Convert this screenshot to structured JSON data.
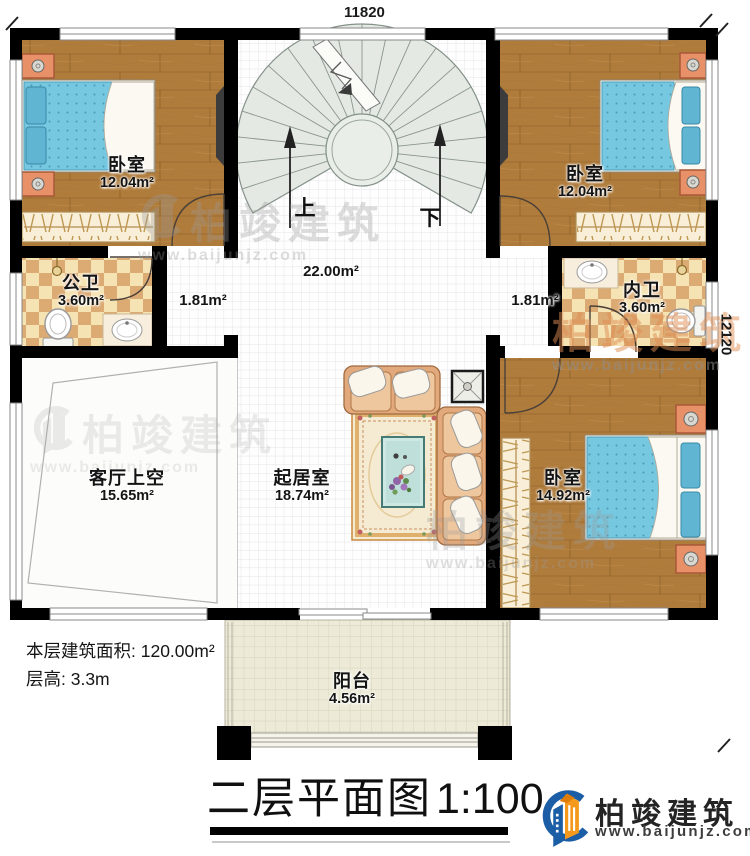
{
  "dimensions": {
    "top": "11820",
    "right": "12120"
  },
  "rooms": {
    "bedroom_tl": {
      "name": "卧室",
      "area": "12.04m²"
    },
    "bedroom_tr": {
      "name": "卧室",
      "area": "12.04m²"
    },
    "bedroom_br": {
      "name": "卧室",
      "area": "14.92m²"
    },
    "public_bath": {
      "name": "公卫",
      "area": "3.60m²"
    },
    "private_bath": {
      "name": "内卫",
      "area": "3.60m²"
    },
    "hall": {
      "area": "22.00m²"
    },
    "corridor_left": {
      "area": "1.81m²"
    },
    "corridor_right": {
      "area": "1.81m²"
    },
    "living_void": {
      "name": "客厅上空",
      "area": "15.65m²"
    },
    "living": {
      "name": "起居室",
      "area": "18.74m²"
    },
    "balcony": {
      "name": "阳台",
      "area": "4.56m²"
    }
  },
  "stairs": {
    "up": "上",
    "down": "下"
  },
  "info": {
    "floor_area": "本层建筑面积: 120.00m²",
    "floor_height": "层高: 3.3m"
  },
  "title": {
    "name": "二层平面图",
    "scale": "1:100"
  },
  "brand": {
    "name": "柏竣建筑",
    "url": "www.baijunjz.com"
  },
  "icons": {
    "stairs": "spiral-staircase-icon",
    "bed": "double-bed-icon",
    "wardrobe": "wardrobe-icon",
    "toilet": "toilet-icon",
    "sink": "sink-icon",
    "sofa": "sofa-icon",
    "rug": "rug-icon",
    "table": "coffee-table-icon",
    "tv": "tv-icon",
    "door": "door-arc-icon",
    "window": "window-icon"
  },
  "colors": {
    "wall": "#000000",
    "wood": "#b07c3c",
    "mattress": "#76c7e0",
    "tile_light": "#f6e3b3",
    "tile_dark": "#dcab74",
    "stair": "#e4eae3",
    "balcony": "#edebd8",
    "brand_blue": "#1b5ea6",
    "brand_orange": "#f5991d"
  }
}
